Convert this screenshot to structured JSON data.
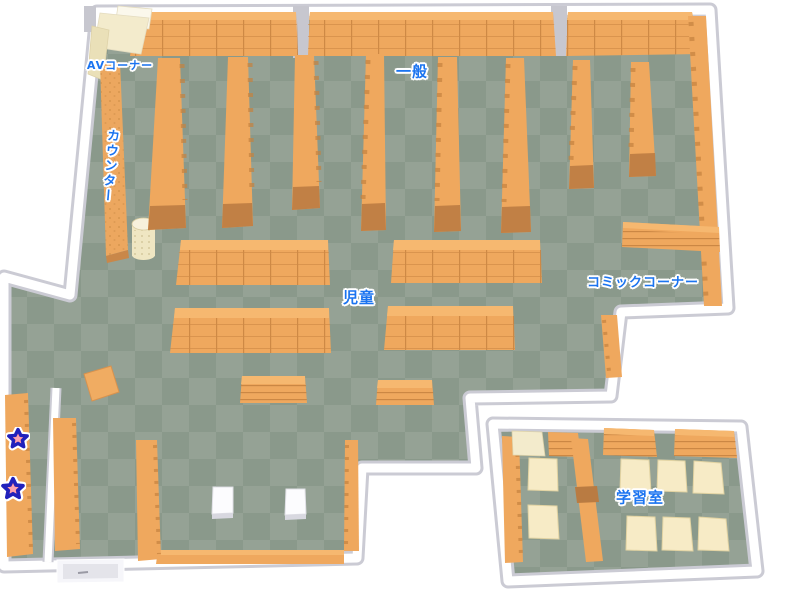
{
  "map": {
    "areas": [
      {
        "id": "av_corner",
        "label": "AVコーナー"
      },
      {
        "id": "counter",
        "label": "カウンター"
      },
      {
        "id": "general",
        "label": "一般"
      },
      {
        "id": "children",
        "label": "児童"
      },
      {
        "id": "comic_corner",
        "label": "コミックコーナー"
      },
      {
        "id": "study_room",
        "label": "学習室"
      }
    ],
    "markers": [
      {
        "icon": "star-marker",
        "fill": "#F4677A",
        "outline": "#2121BC"
      },
      {
        "icon": "star-marker",
        "fill": "#F4677A",
        "outline": "#2121BC"
      }
    ],
    "palette": {
      "floor_dark": "#8A998B",
      "floor_light": "#95A295",
      "shelf_top": "#EFA85E",
      "shelf_highlight": "#F6B870",
      "shelf_side": "#C18045",
      "shelf_line": "#C5813F",
      "wall_face": "#FFFFFF",
      "wall_shadow": "#CBCBD4",
      "table_cream": "#F7EBC6",
      "av_unit_cream": "#F3EBCC",
      "bench_white": "#FCFCFE",
      "label_text": "#1B74F0",
      "label_halo": "#FFFFFF"
    }
  }
}
